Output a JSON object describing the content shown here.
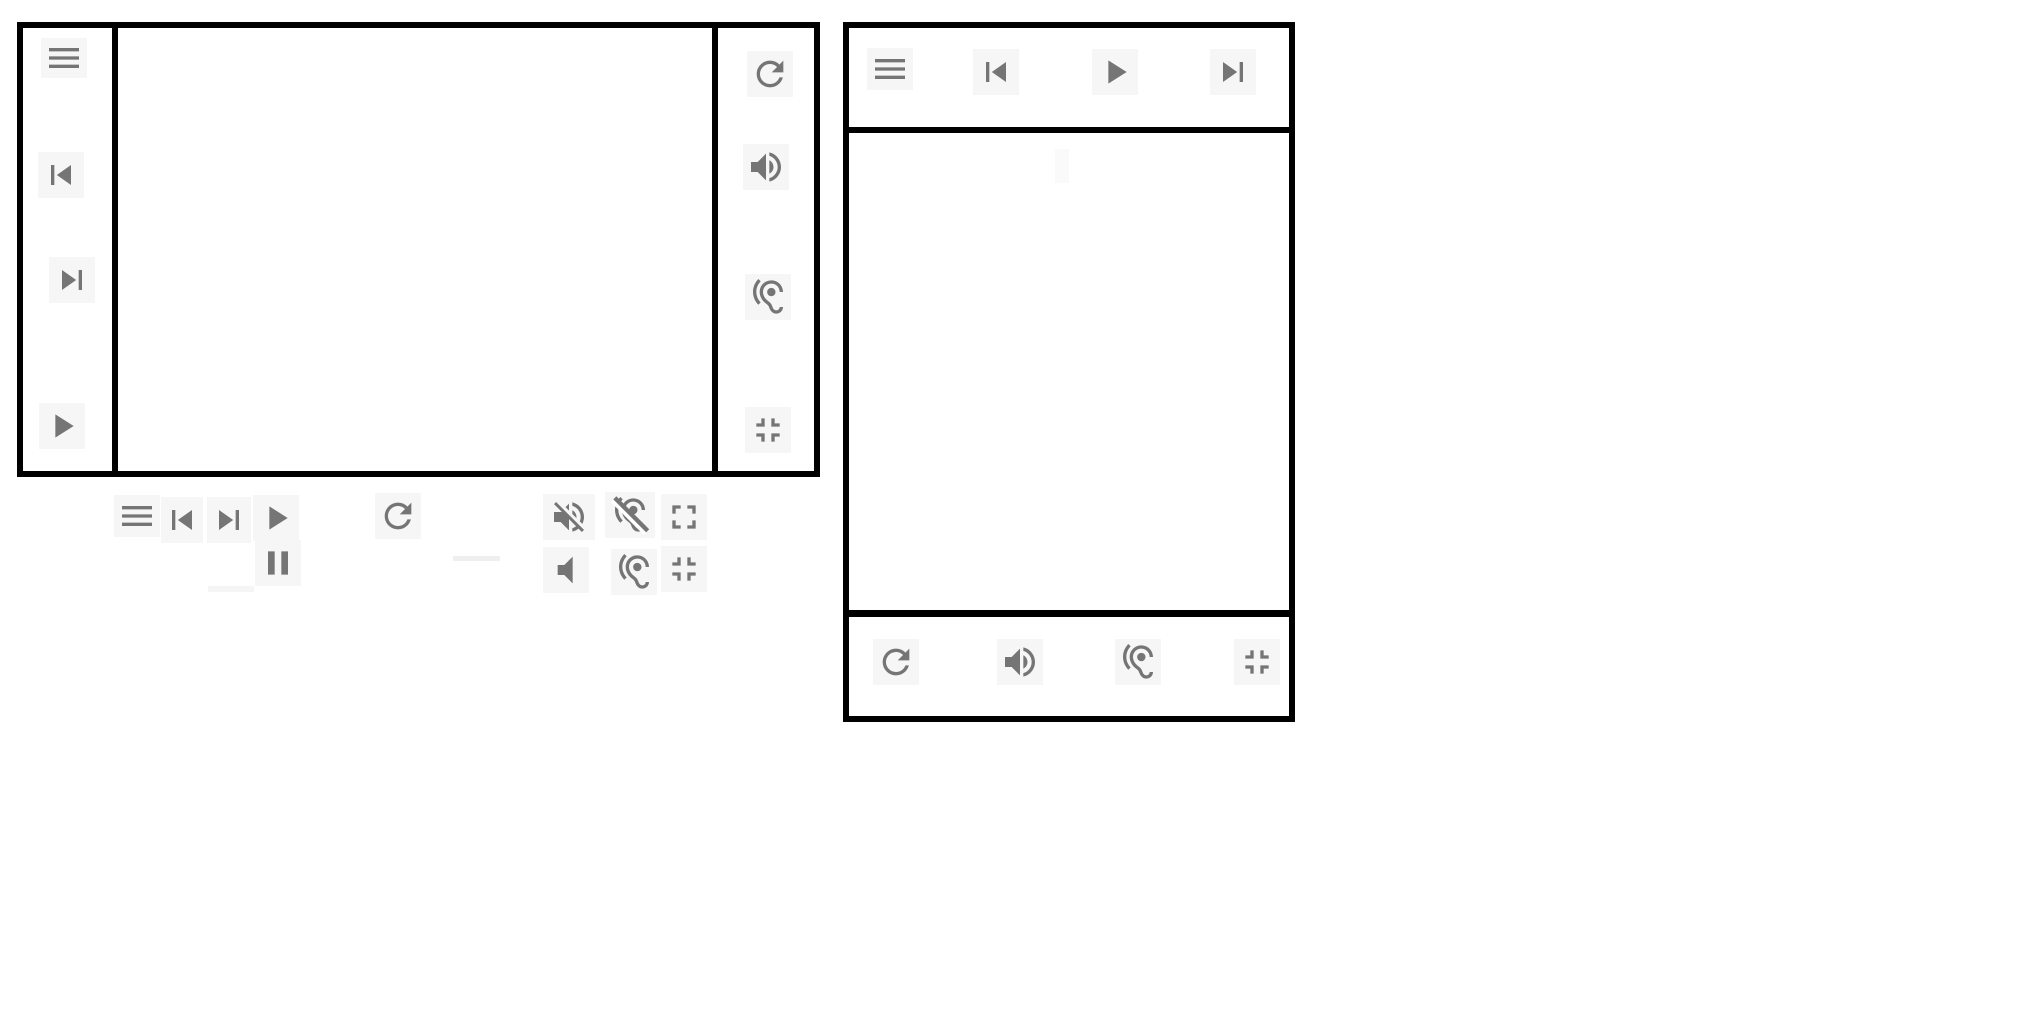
{
  "app": {
    "background": "#ffffff"
  },
  "colors": {
    "icon": "#757575",
    "plate": "#f6f6f6",
    "border": "#000000"
  },
  "player_a": {
    "left_toolbar": {
      "icons": [
        "menu",
        "skip-previous",
        "skip-next",
        "play"
      ]
    },
    "right_toolbar": {
      "icons": [
        "refresh",
        "volume-up",
        "hearing",
        "fullscreen-exit"
      ]
    },
    "main_area": {
      "content": ""
    }
  },
  "floating_controls": {
    "row1": {
      "icons": [
        "menu",
        "skip-previous",
        "skip-next",
        "play",
        "refresh",
        "volume-off",
        "hearing-disabled",
        "fullscreen"
      ]
    },
    "row2": {
      "icons": [
        "pause",
        "volume-mute",
        "hearing",
        "fullscreen-exit"
      ]
    }
  },
  "player_b": {
    "top_toolbar": {
      "icons": [
        "menu",
        "skip-previous",
        "play",
        "skip-next"
      ]
    },
    "bottom_toolbar": {
      "icons": [
        "refresh",
        "volume-up",
        "hearing",
        "fullscreen-exit"
      ]
    },
    "main_area": {
      "content": ""
    }
  }
}
